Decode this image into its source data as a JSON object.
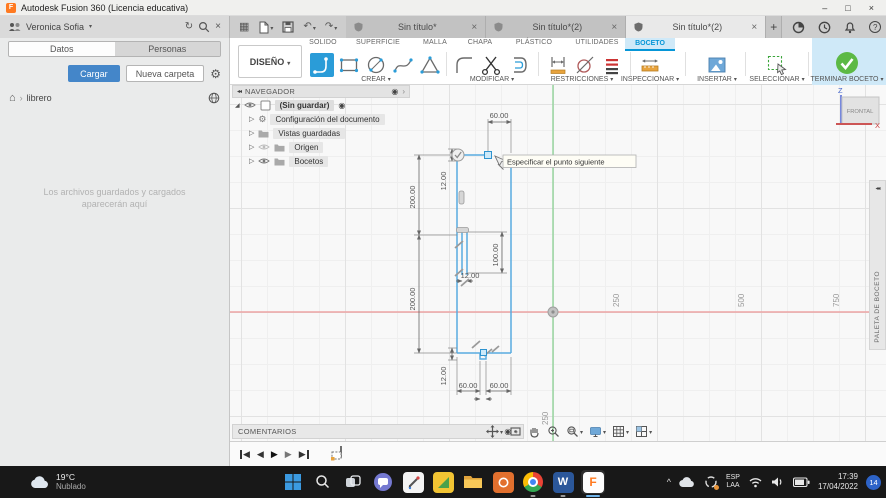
{
  "window": {
    "title": "Autodesk Fusion 360 (Licencia educativa)"
  },
  "header": {
    "user_name": "Veronica Sofia",
    "doc_tabs": [
      {
        "label": "Sin título*"
      },
      {
        "label": "Sin título*(2)"
      },
      {
        "label": "Sin título*(2)"
      }
    ]
  },
  "left_panel": {
    "tab_datos": "Datos",
    "tab_personas": "Personas",
    "cargar_button": "Cargar",
    "nueva_carpeta_button": "Nueva carpeta",
    "breadcrumb": "librero",
    "empty_text": "Los archivos guardados y cargados aparecerán aquí"
  },
  "ribbon": {
    "diseno_button": "DISEÑO",
    "env_tabs": [
      "SOLIDO",
      "SUPERFICIE",
      "MALLA",
      "CHAPA",
      "PLÁSTICO",
      "UTILIDADES",
      "BOCETO"
    ],
    "groups": {
      "crear": "CREAR",
      "modificar": "MODIFICAR",
      "restricciones": "RESTRICCIONES",
      "inspeccionar": "INSPECCIONAR",
      "insertar": "INSERTAR",
      "seleccionar": "SELECCIONAR",
      "terminar": "TERMINAR BOCETO"
    }
  },
  "navigator": {
    "title": "NAVEGADOR",
    "root_label": "(Sin guardar)",
    "items": [
      {
        "label": "Configuración del documento"
      },
      {
        "label": "Vistas guardadas"
      },
      {
        "label": "Origen"
      },
      {
        "label": "Bocetos"
      }
    ]
  },
  "canvas": {
    "tooltip": "Especificar el punto siguiente",
    "dims": {
      "top": "60.00",
      "top_wall": "12.00",
      "upper_left": "200.00",
      "slot_height": "100.00",
      "slot_width": "12.00",
      "lower_left": "200.00",
      "bottom_wall": "12.00",
      "bottom_left": "60.00",
      "bottom_right": "60.00"
    },
    "ruler_x": [
      "250",
      "500",
      "750"
    ],
    "ruler_y": "250",
    "viewcube_face": "FRONTAL",
    "axis_z": "Z",
    "axis_x": "X",
    "palette_title": "PALETA DE BOCETO",
    "comments_title": "COMENTARIOS"
  },
  "taskbar": {
    "weather_temp": "19°C",
    "weather_desc": "Nublado",
    "lang_line1": "ESP",
    "lang_line2": "LAA",
    "clock_time": "17:39",
    "clock_date": "17/04/2022",
    "notification_badge": "14"
  },
  "icons": {
    "caret_up": "^",
    "close": "×",
    "minimize": "–",
    "maximize": "□",
    "chevron_down": "▾",
    "user_chevron": "▾",
    "refresh": "↻",
    "undo": "↶",
    "redo": "↷",
    "grid_menu": "▦",
    "home": "⌂",
    "crumb_sep": "›",
    "gear": "⚙",
    "collapse": "◂◂",
    "radio": "◉",
    "panel_arrow": "›",
    "expand": "▷",
    "root_corner": "◢",
    "plus": "+",
    "play_back": "◀",
    "play_fwd": "▶",
    "logo_letter": "F"
  },
  "colors": {
    "accent_blue": "#0696d7",
    "active_tool_blue": "#2a9cd8",
    "terminar_green": "#5cb945",
    "cargar_blue": "#4486c9",
    "axis_red": "#eda4a4",
    "axis_green": "#93d49b",
    "sketch_blue": "#58abdf",
    "fusion_orange": "#ff7a21"
  }
}
